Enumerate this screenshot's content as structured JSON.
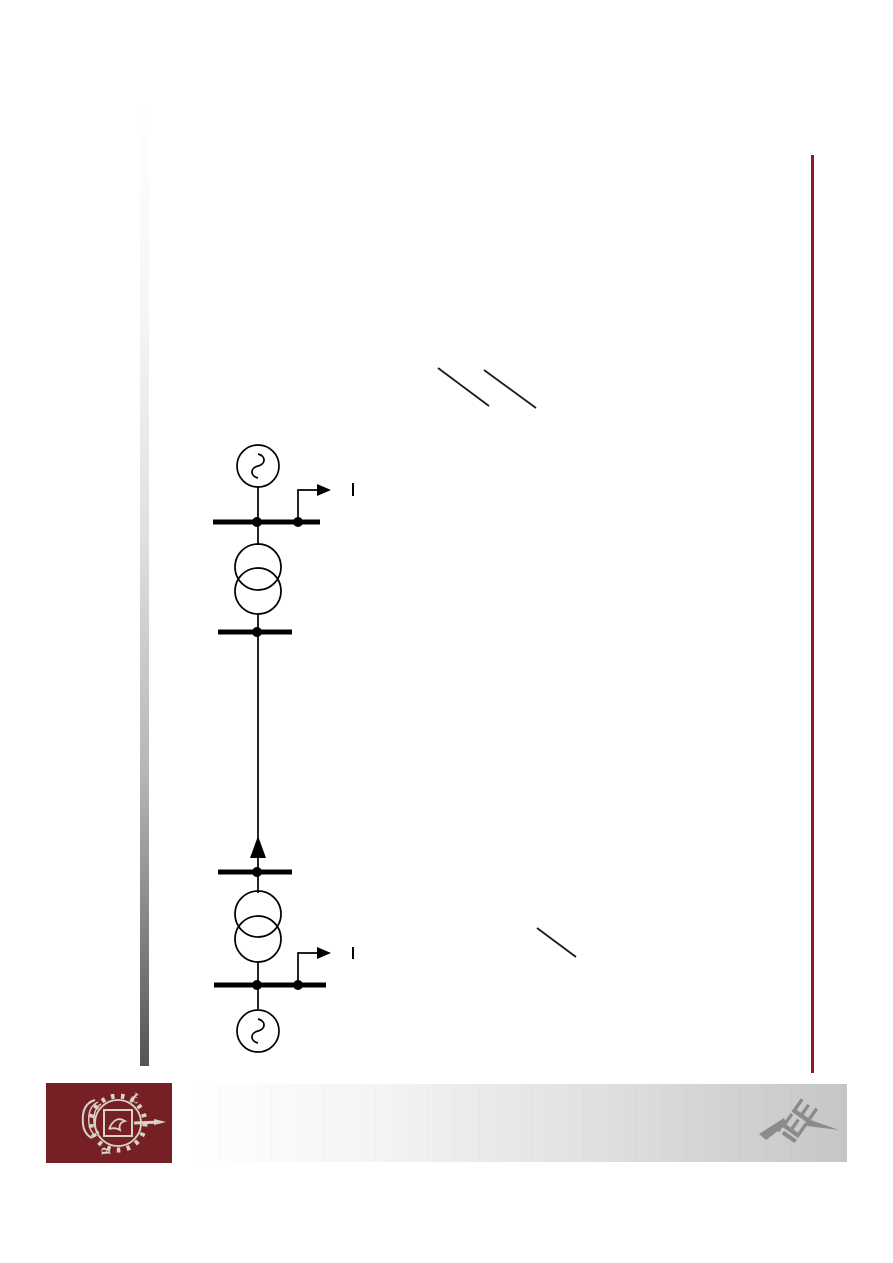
{
  "page": {
    "kind": "presentation-slide",
    "background_color": "#ffffff",
    "visible_text": []
  },
  "decor": {
    "left_gradient_bar": {
      "top_color": "#ffffff",
      "bottom_color": "#545454"
    },
    "right_accent_rule": {
      "color": "#8e1b23"
    },
    "footer_gradient_bar": {
      "left_color": "#ffffff",
      "right_color": "#c6c6c6"
    }
  },
  "logos": {
    "bottom_left": {
      "name": "politechnika-lodzka-emblem",
      "background_color": "#762026",
      "emblem_color": "#d9d2c9"
    },
    "bottom_right": {
      "name": "iee-institute-logo",
      "color": "#8b8b8b",
      "letters": "iEE"
    }
  },
  "diagram": {
    "type": "power-system-one-line-diagram",
    "stroke_color": "#000000",
    "components": [
      {
        "id": "generator-top",
        "kind": "synchronous-generator-symbol"
      },
      {
        "id": "busbar-top",
        "kind": "busbar-with-two-junction-dots"
      },
      {
        "id": "tap-arrow-top",
        "kind": "bent-measurement-arrow-right"
      },
      {
        "id": "transformer-top",
        "kind": "two-winding-transformer-symbol"
      },
      {
        "id": "busbar-upper-mid",
        "kind": "busbar-with-junction-dot"
      },
      {
        "id": "transmission-line",
        "kind": "vertical-line"
      },
      {
        "id": "power-flow-arrow",
        "kind": "solid-arrowhead-pointing-up"
      },
      {
        "id": "busbar-lower-mid",
        "kind": "busbar-with-junction-dot"
      },
      {
        "id": "transformer-bottom",
        "kind": "two-winding-transformer-symbol"
      },
      {
        "id": "tap-arrow-bottom",
        "kind": "bent-measurement-arrow-right"
      },
      {
        "id": "busbar-bottom",
        "kind": "busbar-with-two-junction-dots"
      },
      {
        "id": "generator-bottom",
        "kind": "synchronous-generator-symbol"
      }
    ]
  },
  "annotations": {
    "slash_marks": [
      {
        "id": "slash-top-1",
        "direction": "backslash"
      },
      {
        "id": "slash-top-2",
        "direction": "backslash"
      },
      {
        "id": "slash-bottom",
        "direction": "backslash"
      }
    ],
    "tick_marks": [
      {
        "id": "tick-top",
        "glyph": "|"
      },
      {
        "id": "tick-bottom",
        "glyph": "|"
      }
    ]
  }
}
